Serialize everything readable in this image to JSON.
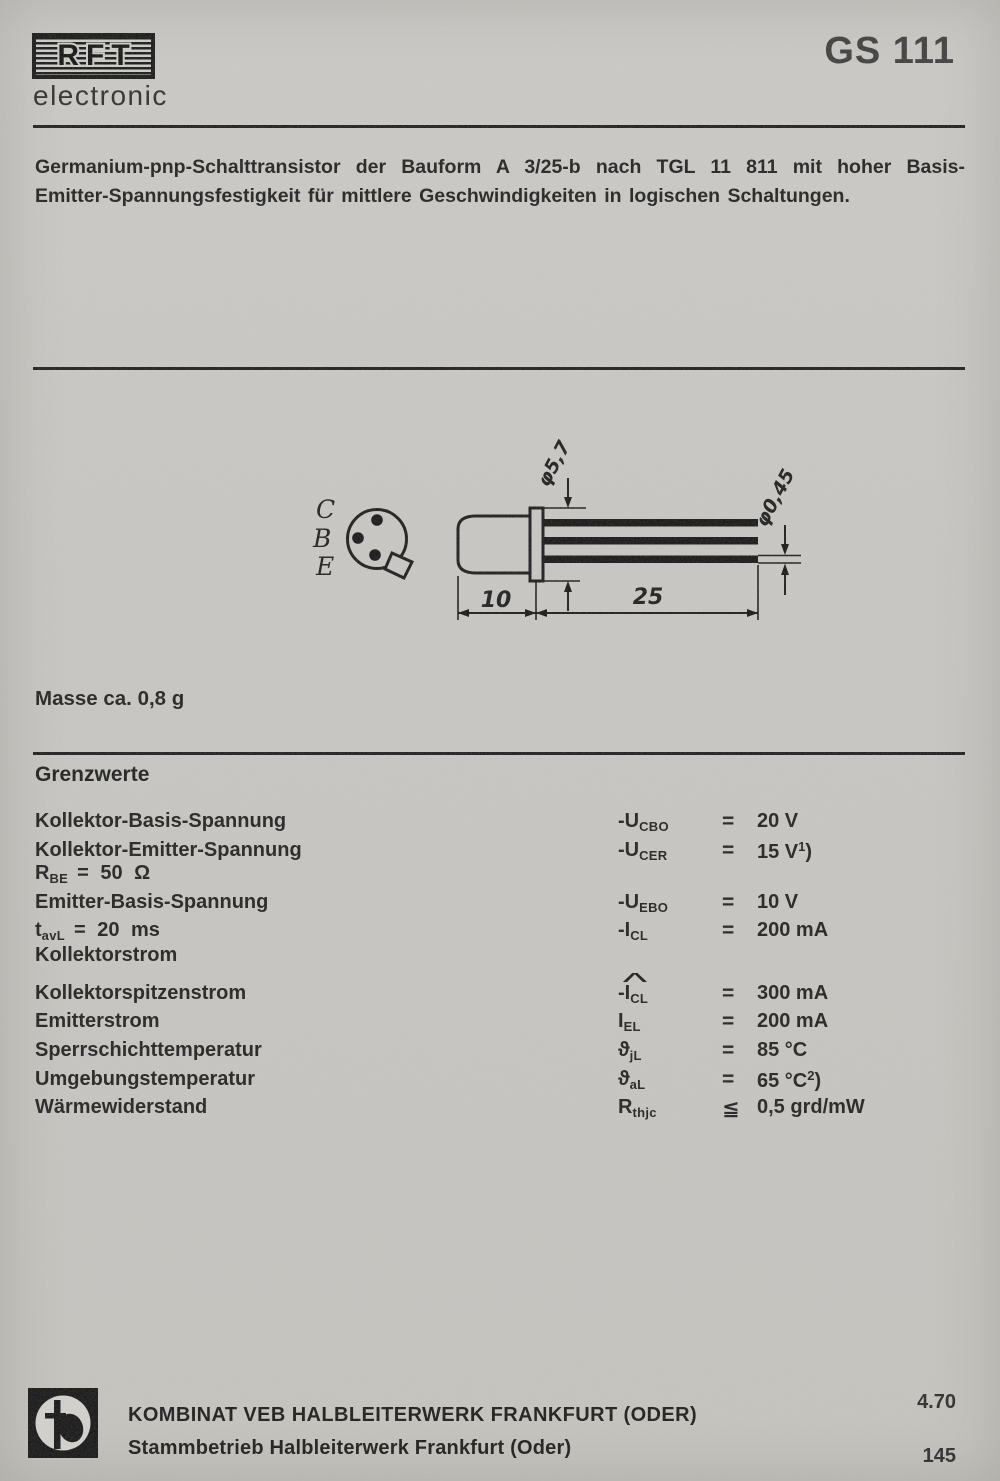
{
  "header": {
    "logo_text": "RFT",
    "logo_subtext": "electronic",
    "product_code": "GS 111"
  },
  "intro": {
    "line1": "Germanium-pnp-Schalttransistor der Bauform A 3/25-b nach TGL 11 811 mit hoher Basis-",
    "line2": "Emitter-Spannungsfestigkeit für mittlere Geschwindigkeiten in logischen Schaltungen."
  },
  "figure": {
    "pin_labels": {
      "collector": "C",
      "base": "B",
      "emitter": "E"
    },
    "dims": {
      "flange_diameter": "φ5,7",
      "lead_diameter": "φ0,45",
      "body_length": "10",
      "lead_length": "25"
    }
  },
  "mass_note": "Masse ca. 0,8 g",
  "limits": {
    "title": "Grenzwerte",
    "rows": [
      {
        "label": "Kollektor-Basis-Spannung",
        "sym_main": "-U",
        "sym_sub": "CBO",
        "rel": "=",
        "val": "20 V"
      },
      {
        "label": "Kollektor-Emitter-Spannung",
        "sym_main": "-U",
        "sym_sub": "CER",
        "rel": "=",
        "val": "15 V",
        "val_sup": "1",
        "val_tail": ")"
      },
      {
        "cond_main": "R",
        "cond_sub": "BE",
        "cond_rest": "= 50 Ω"
      },
      {
        "label": "Emitter-Basis-Spannung",
        "sym_main": "-U",
        "sym_sub": "EBO",
        "rel": "=",
        "val": "10 V"
      },
      {
        "cond_main": "t",
        "cond_sub": "avL",
        "cond_rest": "= 20 ms",
        "sym_main": "-I",
        "sym_sub": "CL",
        "rel": "=",
        "val": "200 mA"
      },
      {
        "label": "Kollektorstrom"
      },
      {
        "label": "Kollektorspitzenstrom",
        "sym_hat": "^",
        "sym_main": "-I",
        "sym_sub": "CL",
        "rel": "=",
        "val": "300 mA"
      },
      {
        "label": "Emitterstrom",
        "sym_main": "I",
        "sym_sub": "EL",
        "rel": "=",
        "val": "200 mA"
      },
      {
        "label": "Sperrschichttemperatur",
        "sym_main": "ϑ",
        "sym_sub": "jL",
        "rel": "=",
        "val": "85 °C"
      },
      {
        "label": "Umgebungstemperatur",
        "sym_main": "ϑ",
        "sym_sub": "aL",
        "rel": "=",
        "val": "65 °C",
        "val_sup": "2",
        "val_tail": ")"
      },
      {
        "label": "Wärmewiderstand",
        "sym_main": "R",
        "sym_sub": "thjc",
        "rel": "≦",
        "val": "0,5 grd/mW"
      }
    ]
  },
  "footer": {
    "company_line1": "KOMBINAT VEB HALBLEITERWERK FRANKFURT (ODER)",
    "company_line2": "Stammbetrieb Halbleiterwerk Frankfurt (Oder)",
    "issue_code": "4.70",
    "page_number": "145"
  }
}
